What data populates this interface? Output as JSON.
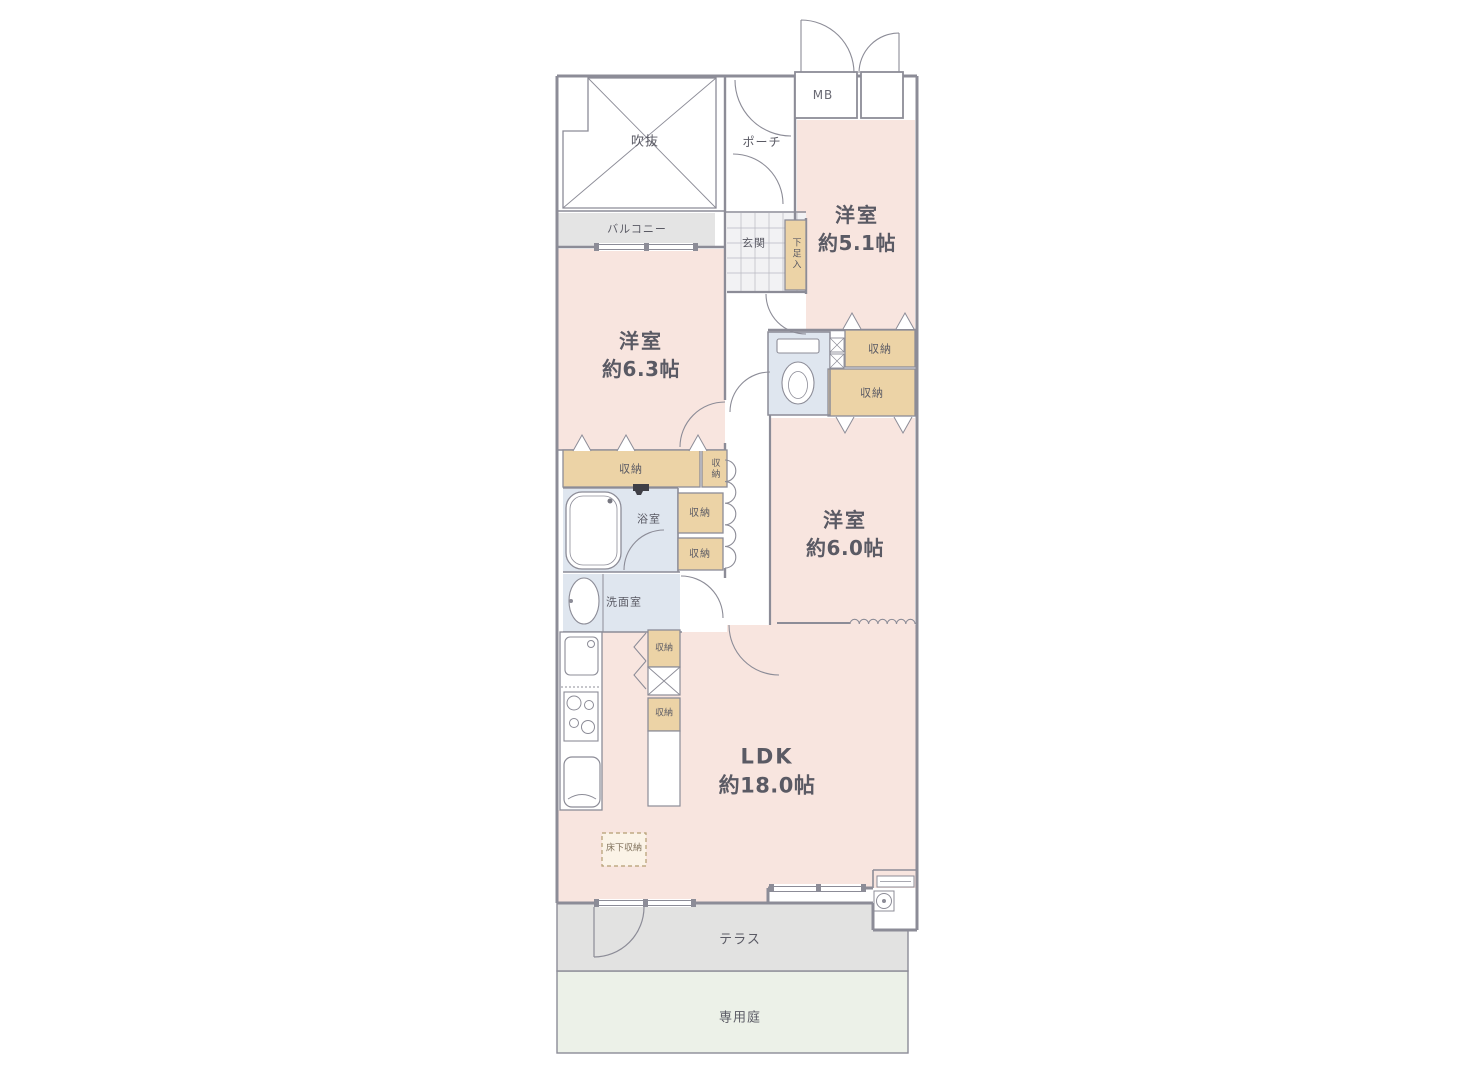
{
  "floorplan": {
    "rooms": {
      "western_5_1": {
        "name": "洋室",
        "size": "約5.1帖"
      },
      "western_6_3": {
        "name": "洋室",
        "size": "約6.3帖"
      },
      "western_6_0": {
        "name": "洋室",
        "size": "約6.0帖"
      },
      "ldk": {
        "name": "LDK",
        "size": "約18.0帖"
      }
    },
    "labels": {
      "void": "吹抜",
      "balcony": "バルコニー",
      "porch": "ポーチ",
      "meter_box": "MB",
      "entrance": "玄関",
      "shoe_cabinet": "下足入",
      "storage": "収納",
      "bathroom": "浴室",
      "washroom": "洗面室",
      "underfloor_storage": "床下収納",
      "terrace": "テラス",
      "private_garden": "専用庭"
    },
    "colors": {
      "room_fill": "#f8e5df",
      "storage_fill": "#ecd3a6",
      "water_fill": "#dfe6ef",
      "tile_fill": "#f2f2f4",
      "balcony_fill": "#e4e4e4",
      "terrace_fill": "#e2e2e1",
      "garden_fill": "#ecf1e8",
      "wall": "#8c8c97",
      "text": "#5a5a64"
    }
  }
}
